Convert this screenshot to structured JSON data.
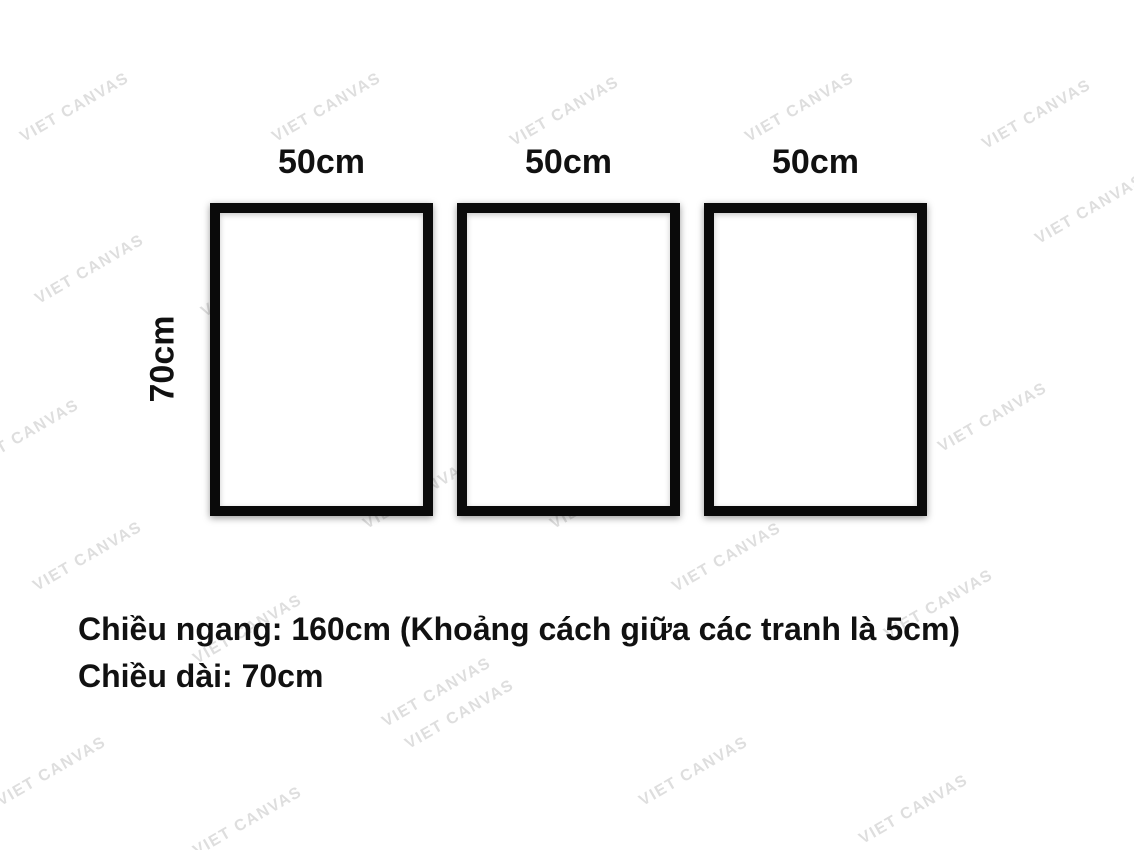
{
  "watermark": {
    "text": "VIET CANVAS",
    "color": "#dedede"
  },
  "frames": {
    "height_label": "70cm",
    "border_color": "#0a0a0a",
    "items": [
      {
        "width_label": "50cm"
      },
      {
        "width_label": "50cm"
      },
      {
        "width_label": "50cm"
      }
    ]
  },
  "caption": {
    "line1": "Chiều ngang: 160cm (Khoảng cách giữa các tranh là 5cm)",
    "line2": "Chiều dài: 70cm"
  },
  "colors": {
    "background": "#ffffff",
    "text": "#111111"
  }
}
